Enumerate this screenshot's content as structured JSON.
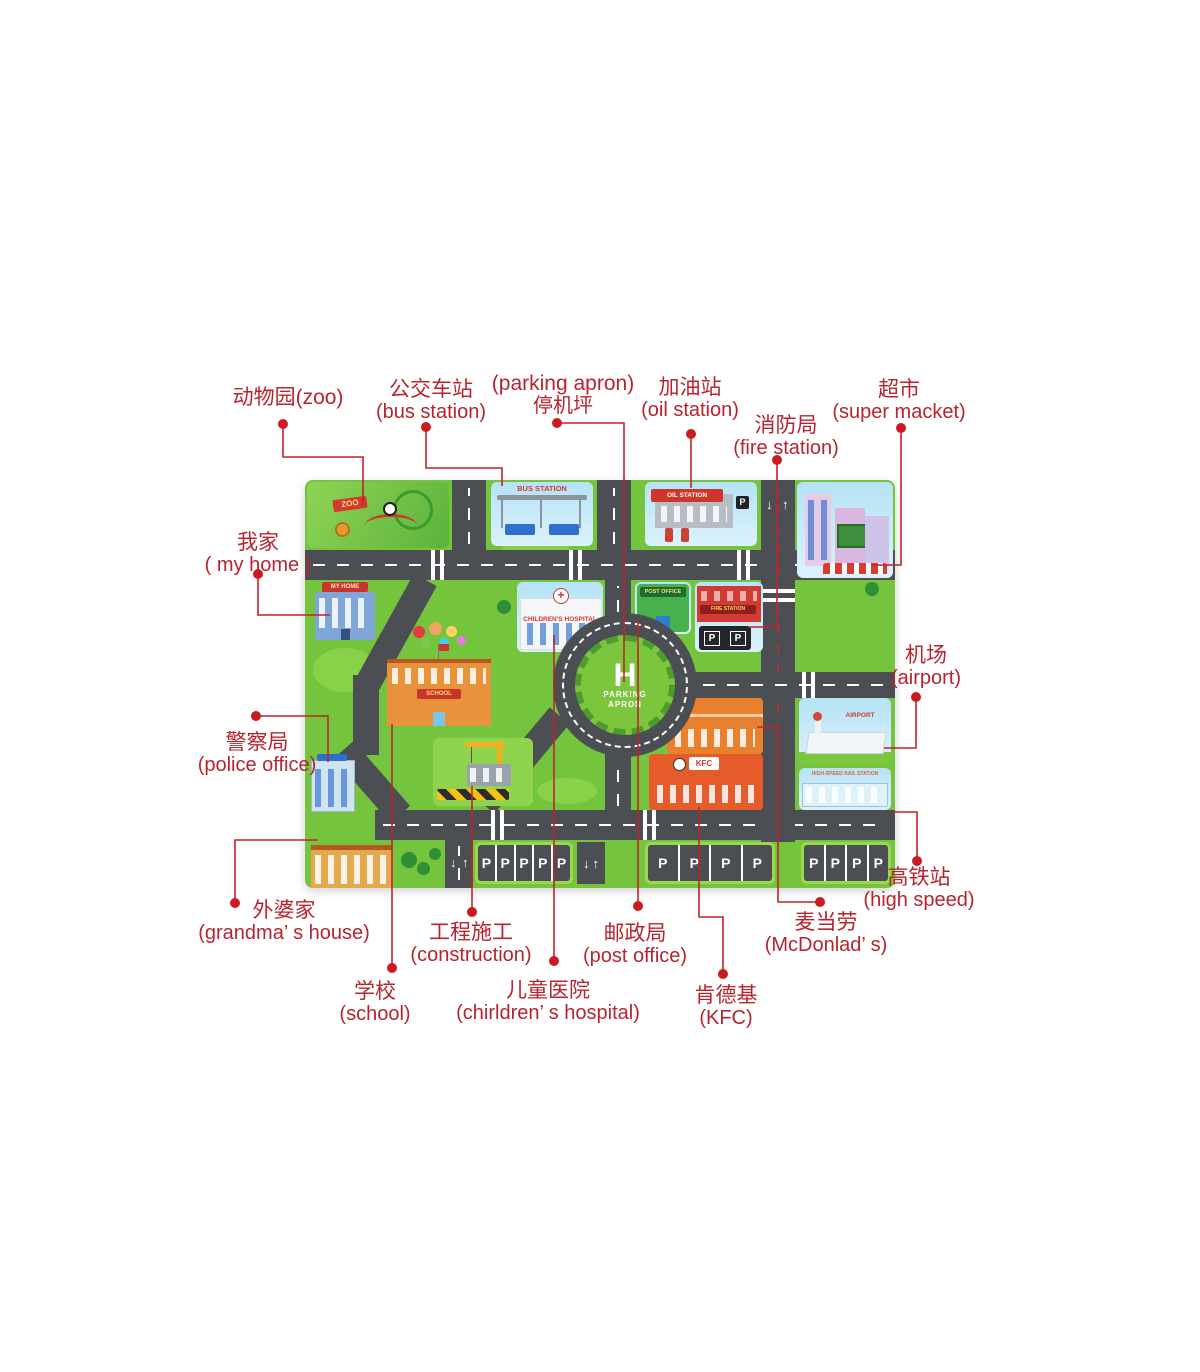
{
  "colors": {
    "label_text": "#b8242e",
    "leader_line": "#bf242b",
    "leader_dot": "#cb1b22",
    "road": "#4b4e52",
    "grass": "#74c43e",
    "background": "#ffffff"
  },
  "callouts": [
    {
      "id": "zoo",
      "line1": "动物园(zoo)",
      "line2": ""
    },
    {
      "id": "bus-station",
      "line1": "公交车站",
      "line2": "(bus station)"
    },
    {
      "id": "parking-apron",
      "line1": "(parking apron)",
      "line2": "停机坪"
    },
    {
      "id": "oil-station",
      "line1": "加油站",
      "line2": "(oil station)"
    },
    {
      "id": "fire-station",
      "line1": "消防局",
      "line2": "(fire station)"
    },
    {
      "id": "supermarket",
      "line1": "超市",
      "line2": "(super macket)"
    },
    {
      "id": "my-home",
      "line1": "我家",
      "line2": "( my home )"
    },
    {
      "id": "police-office",
      "line1": "警察局",
      "line2": "(police office)"
    },
    {
      "id": "grandma-house",
      "line1": "外婆家",
      "line2": "(grandma’ s house)"
    },
    {
      "id": "construction",
      "line1": "工程施工",
      "line2": "(construction)"
    },
    {
      "id": "school",
      "line1": "学校",
      "line2": "(school)"
    },
    {
      "id": "childrens-hospital",
      "line1": "儿童医院",
      "line2": "(chirldren’ s hospital)"
    },
    {
      "id": "post-office",
      "line1": "邮政局",
      "line2": "(post office)"
    },
    {
      "id": "kfc",
      "line1": "肯德基",
      "line2": "(KFC)"
    },
    {
      "id": "mcdonalds",
      "line1": "麦当劳",
      "line2": "(McDonlad’ s)"
    },
    {
      "id": "high-speed",
      "line1": "高铁站",
      "line2": "(high speed)"
    },
    {
      "id": "airport",
      "line1": "机场",
      "line2": "(airport)"
    }
  ],
  "map": {
    "signs": {
      "zoo": "ZOO",
      "bus_station": "BUS STATION",
      "oil_station": "OIL STATION",
      "my_home": "MY HOME",
      "childrens_hospital": "CHILDREN'S HOSPITAL",
      "post_office": "POST OFFICE",
      "fire_station": "FIRE STATION",
      "school": "SCHOOL",
      "mcdonalds_m": "M",
      "kfc": "KFC",
      "airport": "AIRPORT",
      "high_speed_rail": "HIGH-SPEED RAIL STATION",
      "roundabout_h": "H",
      "roundabout_label": "PARKING APRON"
    },
    "parking_letter": "P",
    "parking_rows": [
      5,
      4,
      4
    ],
    "road_marks": {
      "up": "↑",
      "down": "↓"
    }
  }
}
